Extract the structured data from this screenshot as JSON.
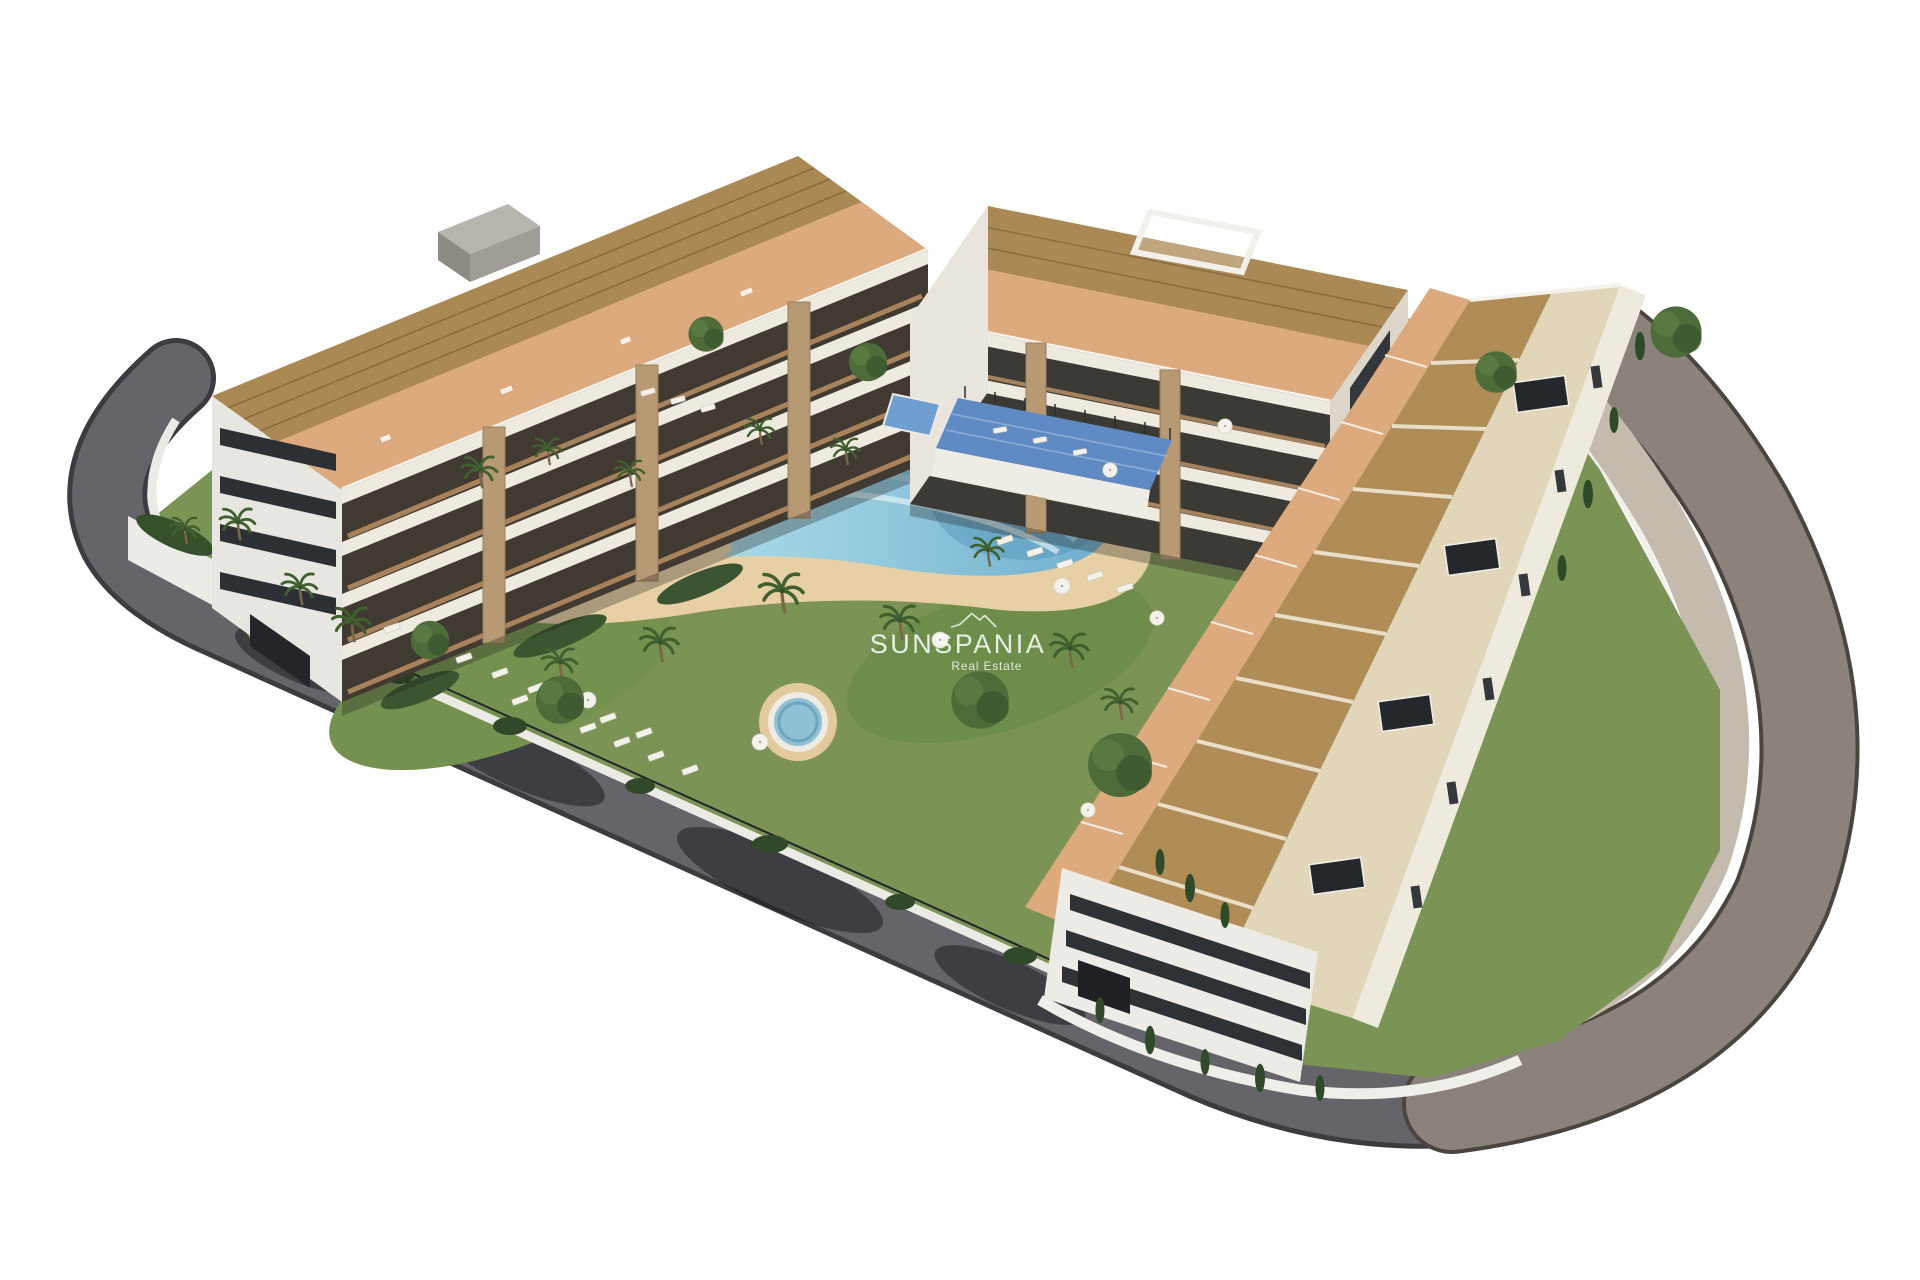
{
  "meta": {
    "kind": "architectural-3d-render",
    "description": "Aerial 3D render of a modern white residential apartment complex with roof pergolas, communal lagoon pool, round plunge pool, gardens, sun loungers and a curving perimeter road, on a white background",
    "background_color": "#ffffff"
  },
  "watermark": {
    "brand": "SUNSPANIA",
    "tagline": "Real Estate",
    "logo_icon": "mountain-peaks-icon",
    "text_color": "#ffffff",
    "opacity": 0.85
  },
  "palette": {
    "road_asphalt_dark": "#64646a",
    "road_asphalt_warm": "#8b837b",
    "sidewalk": "#c4baad",
    "curb_white": "#efede7",
    "building_white": "#efeadf",
    "building_cream_deck": "#e2d6ba",
    "glass_dark": "#34373b",
    "pergola_wood": "#ab8954",
    "terrace_terracotta": "#dcaa7d",
    "stone_pillar": "#b79a73",
    "sand": "#e7d0a5",
    "lawn_green": "#7b9355",
    "foliage_dark": "#2f4a28",
    "pool_aqua": "#9ed2e2",
    "pool_deep": "#5e9fc0",
    "sport_deck_blue": "#5f8ac4"
  }
}
